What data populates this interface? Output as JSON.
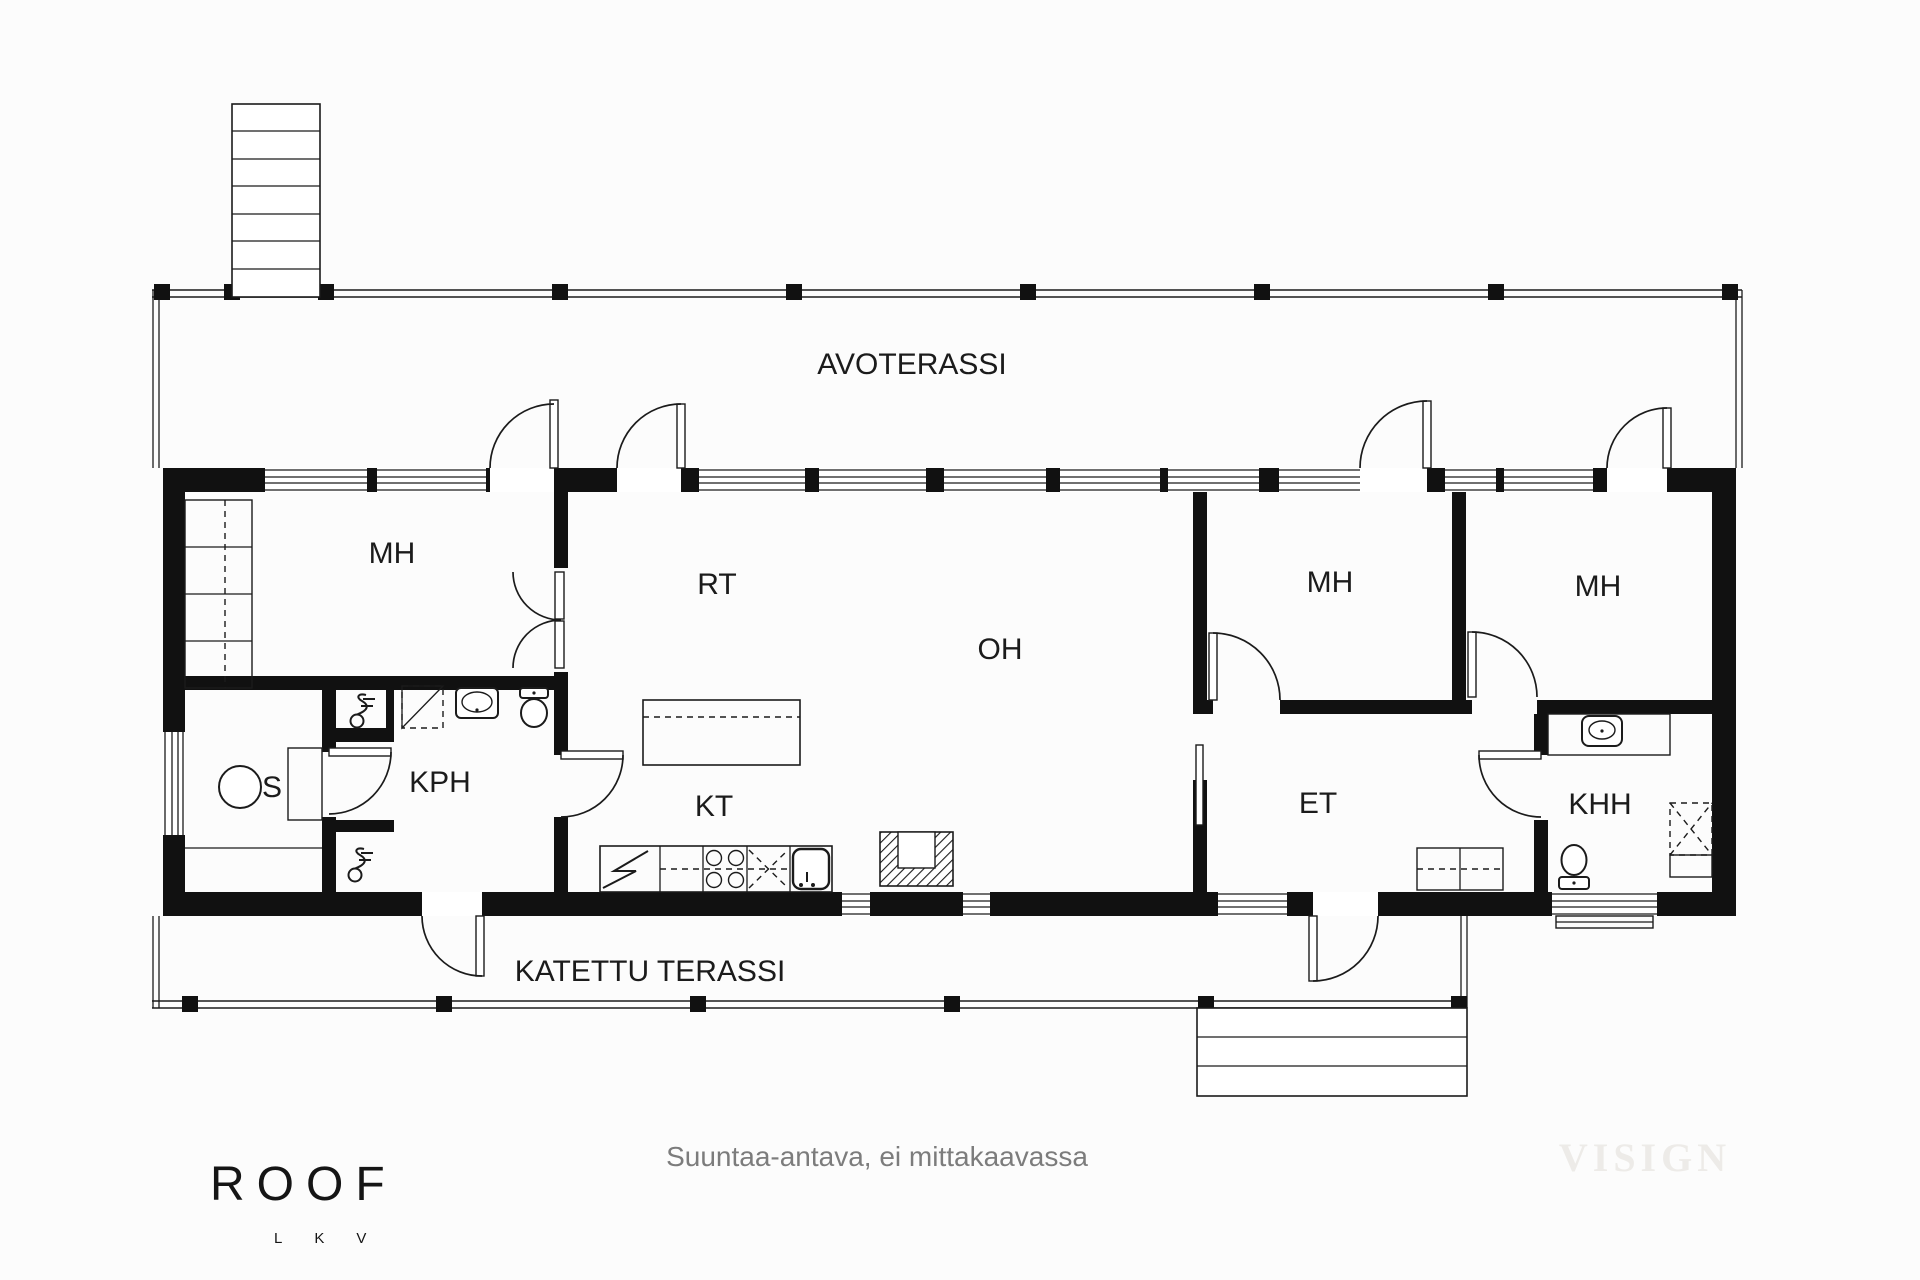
{
  "plan": {
    "terraces": {
      "open_label": "AVOTERASSI",
      "covered_label": "KATETTU TERASSI"
    },
    "rooms": {
      "mh_left": "MH",
      "rt": "RT",
      "oh": "OH",
      "mh_middle": "MH",
      "mh_right": "MH",
      "sauna": "S",
      "kph": "KPH",
      "kt": "KT",
      "et": "ET",
      "khh": "KHH"
    },
    "fixtures": [
      "stairs",
      "terrace-posts",
      "sauna-stove",
      "sauna-bench",
      "shower-mixer",
      "shower-area",
      "washbasin",
      "toilet",
      "wardrobe",
      "kitchen-island",
      "fridge-freezer",
      "cooktop",
      "dishwasher",
      "kitchen-sink",
      "fireplace",
      "utility-counter",
      "washer-dryer",
      "entry-bench",
      "terrace-steps",
      "pocket-door"
    ]
  },
  "footer": {
    "brand": "ROOF",
    "brand_letters": "LKV",
    "disclaimer": "Suuntaa-antava, ei mittakaavassa",
    "watermark": "VISIGN"
  },
  "colors": {
    "ink": "#1b1b1b",
    "wall": "#111111",
    "muted_text": "#7c7c7c",
    "watermark_text": "#edebe8",
    "background": "#fcfcfc"
  }
}
